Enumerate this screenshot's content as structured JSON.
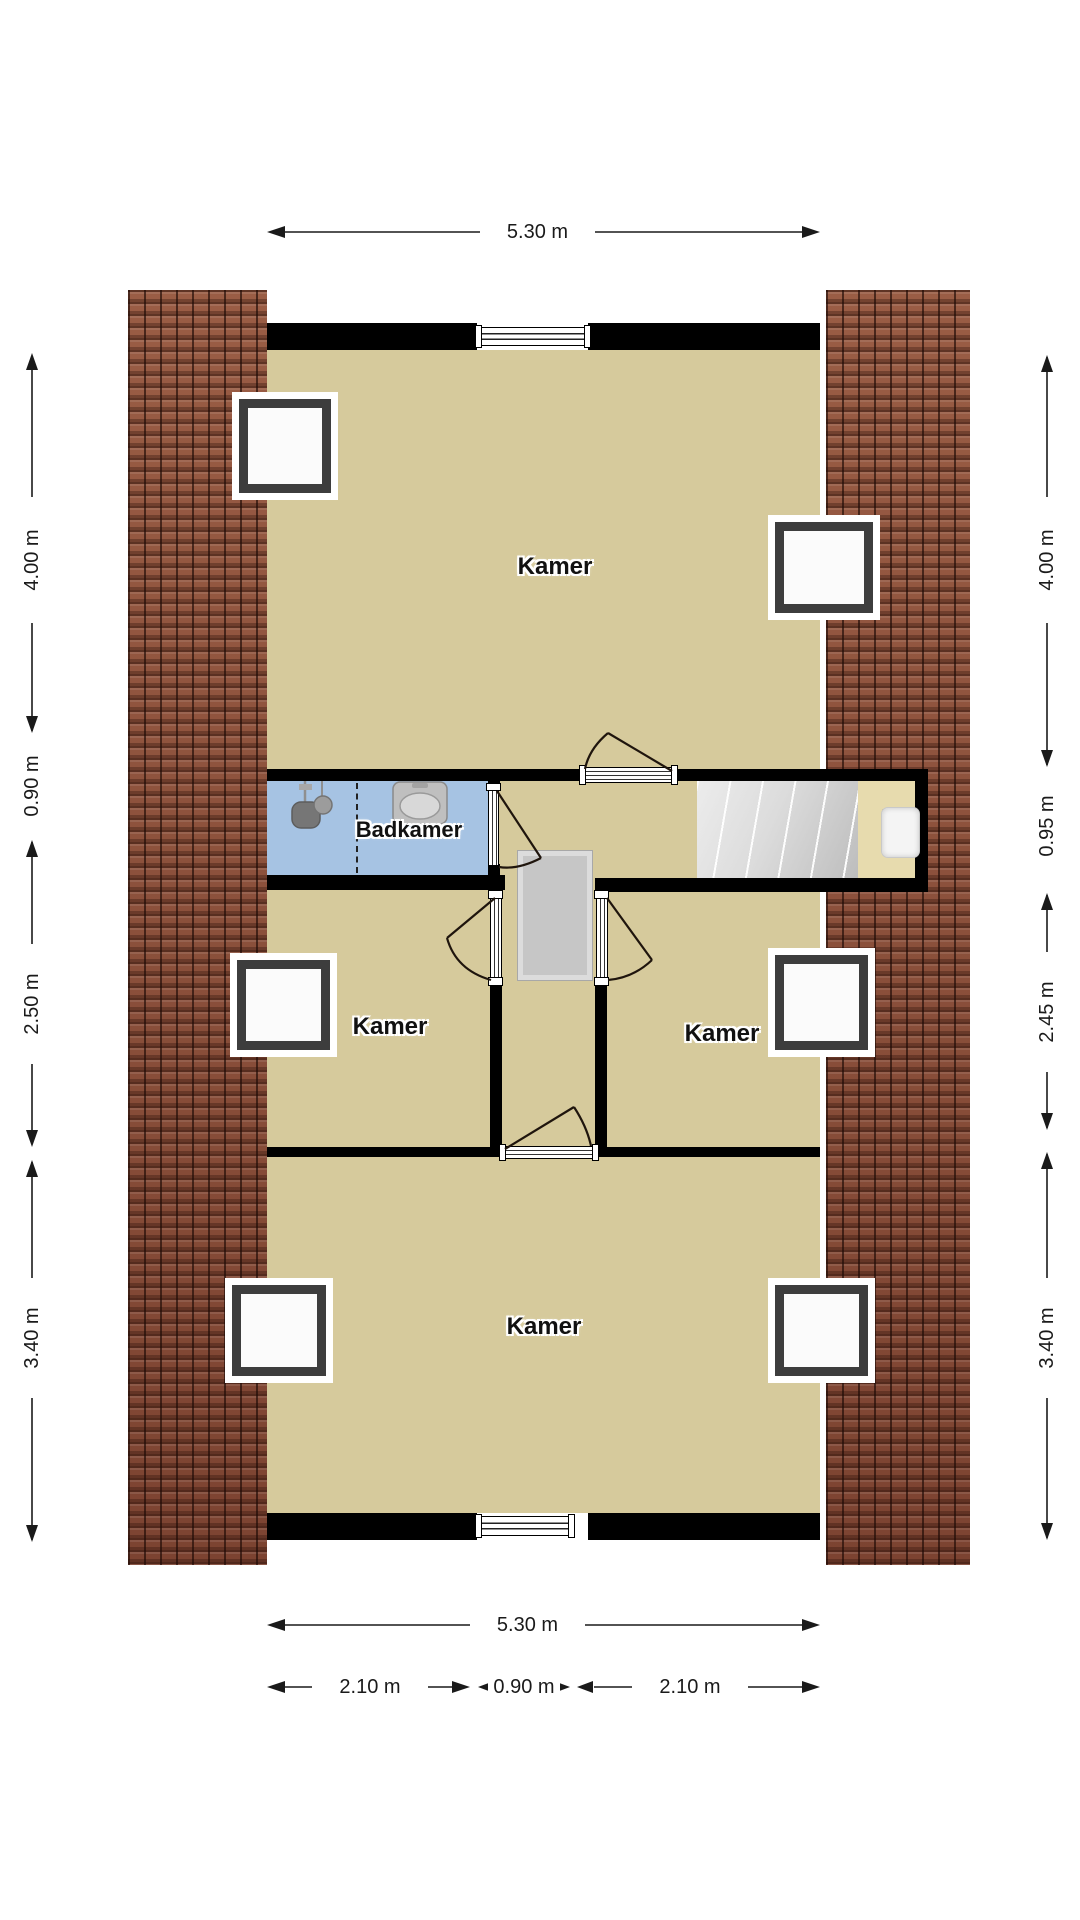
{
  "plan": {
    "type": "floor-plan",
    "floor_name": "attic floor"
  },
  "rooms": [
    {
      "id": "kamer-top",
      "label": "Kamer"
    },
    {
      "id": "badkamer",
      "label": "Badkamer"
    },
    {
      "id": "kamer-left",
      "label": "Kamer"
    },
    {
      "id": "kamer-right",
      "label": "Kamer"
    },
    {
      "id": "kamer-bottom",
      "label": "Kamer"
    }
  ],
  "dimensions": {
    "top_width": "5.30 m",
    "bottom_width": "5.30 m",
    "bottom_segments": [
      "2.10 m",
      "0.90 m",
      "2.10 m"
    ],
    "left": [
      "4.00 m",
      "0.90 m",
      "2.50 m",
      "3.40 m"
    ],
    "right": [
      "4.00 m",
      "0.95 m",
      "2.45 m",
      "3.40 m"
    ]
  },
  "icons": {
    "shower": "shower-head-icon",
    "sink": "sink-icon",
    "outlet": "power-outlet-icon",
    "stairs": "staircase",
    "opening": "floor-opening",
    "skylight": "skylight-window"
  },
  "colors": {
    "floor": "#d6ca9c",
    "bathroom_floor": "#a6c3e3",
    "niche_floor": "#e7dbae",
    "roof_tiles": "#8e5340",
    "walls": "#000000",
    "stairs": "#d9d9d9"
  }
}
